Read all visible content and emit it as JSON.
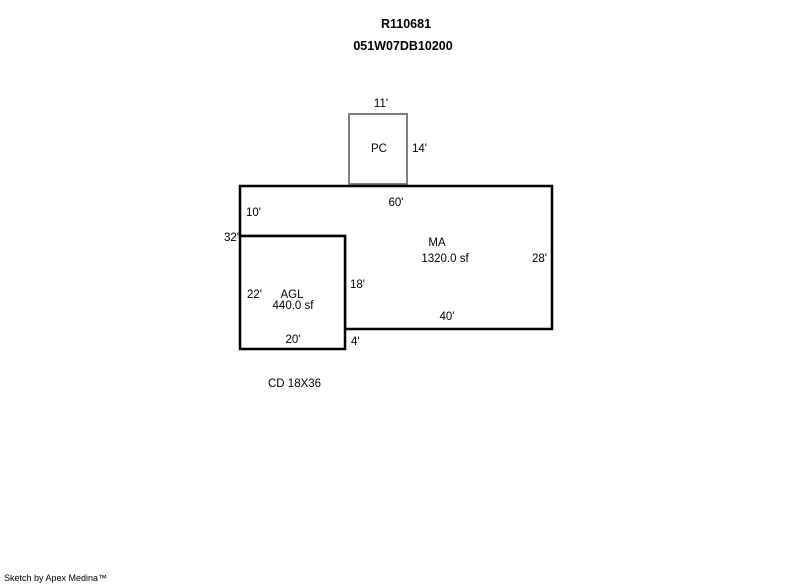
{
  "header": {
    "title": "R110681",
    "subtitle": "051W07DB10200"
  },
  "colors": {
    "background": "#ffffff",
    "main_outline": "#000000",
    "porch_outline": "#808080",
    "text": "#000000"
  },
  "areas": {
    "pc": {
      "label": "PC",
      "dims": {
        "top": "11'",
        "right": "14'"
      }
    },
    "ma": {
      "label": "MA",
      "area": "1320.0 sf",
      "dims": {
        "top": "60'",
        "upper_left": "10'",
        "left_total": "32'",
        "right": "28'",
        "notch_right": "18'",
        "bottom": "40'",
        "step": "4'"
      }
    },
    "agl": {
      "label": "AGL",
      "area": "440.0 sf",
      "dims": {
        "left": "22'",
        "bottom": "20'"
      }
    }
  },
  "note": "CD 18X36",
  "footer": {
    "credit": "Sketch by Apex Medina™"
  }
}
